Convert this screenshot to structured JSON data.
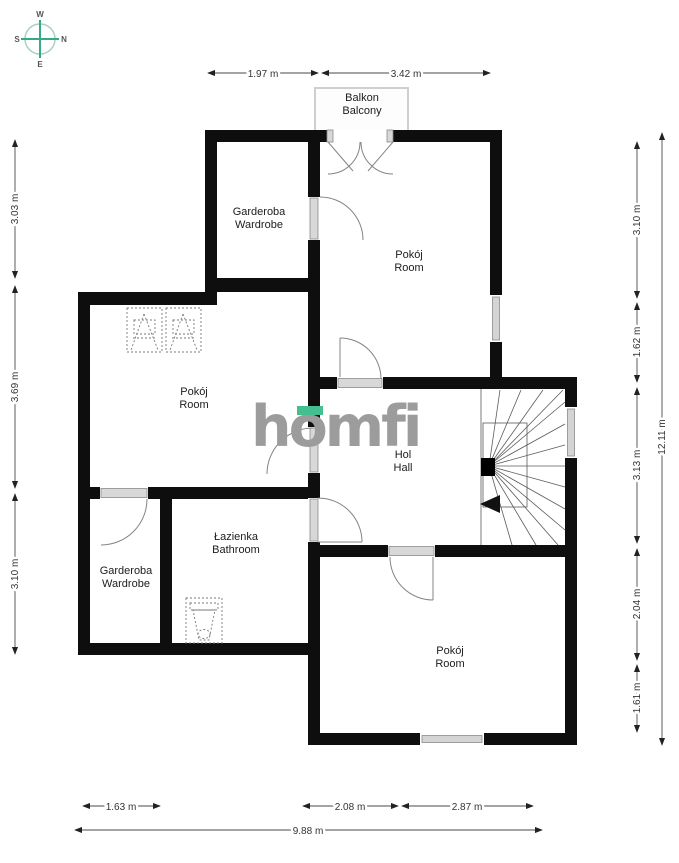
{
  "brand": {
    "logo_text": "homfi"
  },
  "compass": {
    "west": "W",
    "north": "N",
    "south": "S",
    "east": "E"
  },
  "rooms": {
    "balcony": {
      "pl": "Balkon",
      "en": "Balcony"
    },
    "wardrobe_top": {
      "pl": "Garderoba",
      "en": "Wardrobe"
    },
    "room_top": {
      "pl": "Pokój",
      "en": "Room"
    },
    "room_left": {
      "pl": "Pokój",
      "en": "Room"
    },
    "hall": {
      "pl": "Hol",
      "en": "Hall"
    },
    "bathroom": {
      "pl": "Łazienka",
      "en": "Bathroom"
    },
    "wardrobe_bottom": {
      "pl": "Garderoba",
      "en": "Wardrobe"
    },
    "room_bottom": {
      "pl": "Pokój",
      "en": "Room"
    }
  },
  "dimensions": {
    "top": {
      "d1": "1.97 m",
      "d2": "3.42 m"
    },
    "left": {
      "d1": "3.03 m",
      "d2": "3.69 m",
      "d3": "3.10 m"
    },
    "right": {
      "d1": "3.10 m",
      "d2": "1.62 m",
      "d3": "3.13 m",
      "d4": "2.04 m",
      "d5": "1.61 m",
      "total": "12.11 m"
    },
    "bottom": {
      "d1": "1.63 m",
      "d2": "2.08 m",
      "d3": "2.87 m",
      "total": "9.88 m"
    }
  },
  "colors": {
    "wall": "#0e0e0e",
    "accent_teal": "#44bf90",
    "logo_gray": "#9c9c9c",
    "window_fill": "#d4d4d4",
    "dimension_line": "#4a4a4a"
  }
}
